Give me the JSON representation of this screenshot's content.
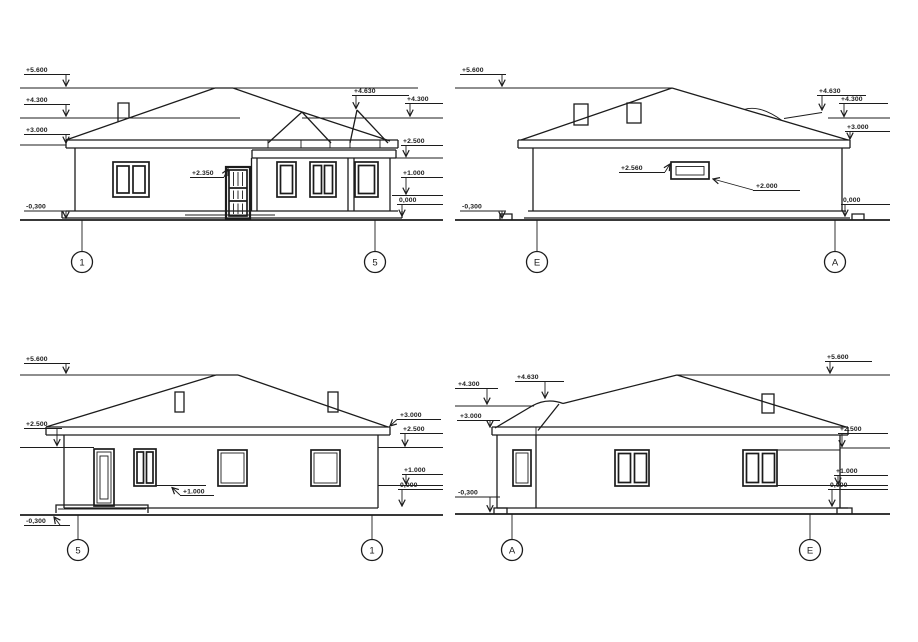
{
  "sheet": {
    "background": "#ffffff",
    "ink": "#1c1c1c"
  },
  "elevations": {
    "front": {
      "axis_left": "1",
      "axis_right": "5",
      "left_levels": [
        "+5.600",
        "+4.300",
        "+3.000",
        "-0,300"
      ],
      "right_levels": [
        "+4.630",
        "+4.300",
        "+2.500",
        "+1.000",
        "0,000"
      ],
      "door_note": "+2.350"
    },
    "right_side": {
      "axis_left": "E",
      "axis_right": "A",
      "left_levels": [
        "+5.600",
        "-0,300"
      ],
      "right_levels": [
        "+4.630",
        "+4.300",
        "+3.000",
        "0,000"
      ],
      "vent_top_note": "+2.560",
      "vent_bottom_note": "+2.000"
    },
    "rear": {
      "axis_left": "5",
      "axis_right": "1",
      "left_levels": [
        "+5.600",
        "+2.500",
        "-0,300"
      ],
      "right_levels": [
        "+3.000",
        "+2.500",
        "+1.000",
        "0,000"
      ],
      "sill_note": "+1.000"
    },
    "left_side": {
      "axis_left": "A",
      "axis_right": "E",
      "left_levels": [
        "+4.300",
        "+3.000",
        "-0,300"
      ],
      "ridge_note": "+4.630",
      "right_levels": [
        "+5.600",
        "+2.500",
        "+1.000",
        "0,000"
      ]
    }
  }
}
